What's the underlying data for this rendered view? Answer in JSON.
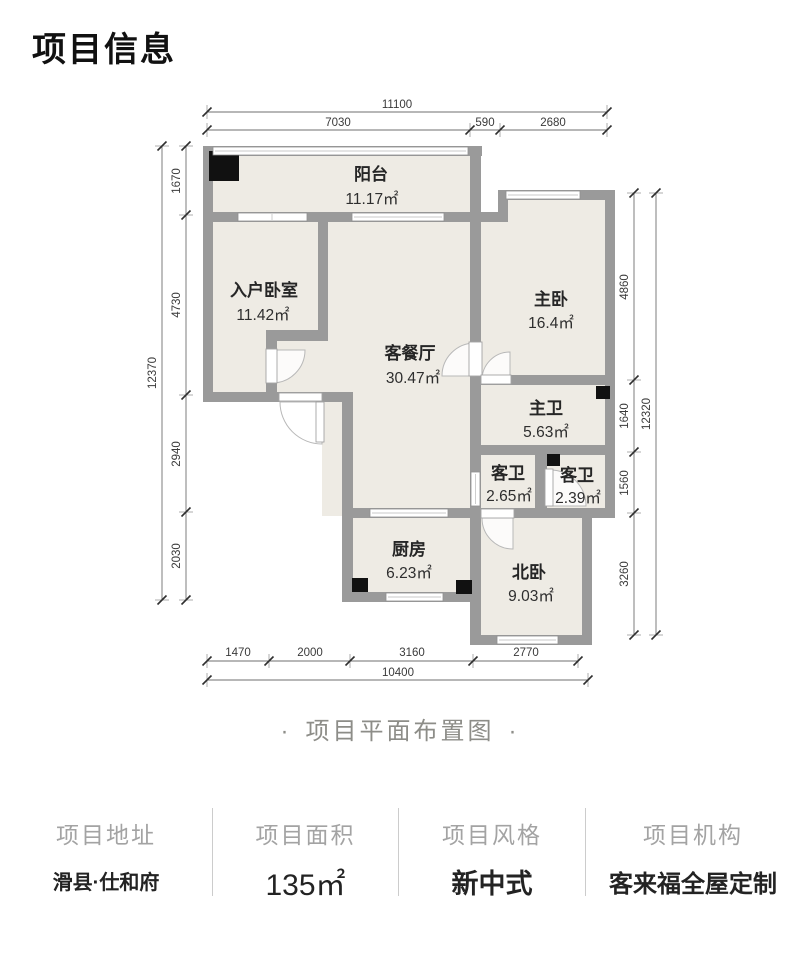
{
  "page_title": "项目信息",
  "caption": {
    "left_bullet": "·",
    "text": "项目平面布置图",
    "right_bullet": "·"
  },
  "floor_plan": {
    "rooms": [
      {
        "name": "阳台",
        "area": "11.17㎡"
      },
      {
        "name": "入户卧室",
        "area": "11.42㎡"
      },
      {
        "name": "客餐厅",
        "area": "30.47㎡"
      },
      {
        "name": "主卧",
        "area": "16.4㎡"
      },
      {
        "name": "主卫",
        "area": "5.63㎡"
      },
      {
        "name": "客卫",
        "area": "2.65㎡"
      },
      {
        "name": "客卫",
        "area": "2.39㎡"
      },
      {
        "name": "厨房",
        "area": "6.23㎡"
      },
      {
        "name": "北卧",
        "area": "9.03㎡"
      }
    ],
    "dimensions": {
      "top": {
        "overall": "11100",
        "segments": [
          "7030",
          "590",
          "2680"
        ]
      },
      "left": {
        "overall": "12370",
        "segments": [
          "1670",
          "4730",
          "2940",
          "2030"
        ]
      },
      "right": {
        "overall": "12320",
        "segments": [
          "4860",
          "1640",
          "1560",
          "3260"
        ]
      },
      "bottom": {
        "overall": "10400",
        "segments": [
          "1470",
          "2000",
          "3160",
          "2770"
        ]
      }
    }
  },
  "info": {
    "columns": [
      {
        "label": "项目地址",
        "value": "滑县·仕和府"
      },
      {
        "label": "项目面积",
        "value": "135㎡"
      },
      {
        "label": "项目风格",
        "value": "新中式"
      },
      {
        "label": "项目机构",
        "value": "客来福全屋定制"
      }
    ]
  },
  "colors": {
    "wall": "#9a9a9a",
    "room_fill": "#eeebe4",
    "column": "#111111",
    "accent_text": "#232323"
  }
}
